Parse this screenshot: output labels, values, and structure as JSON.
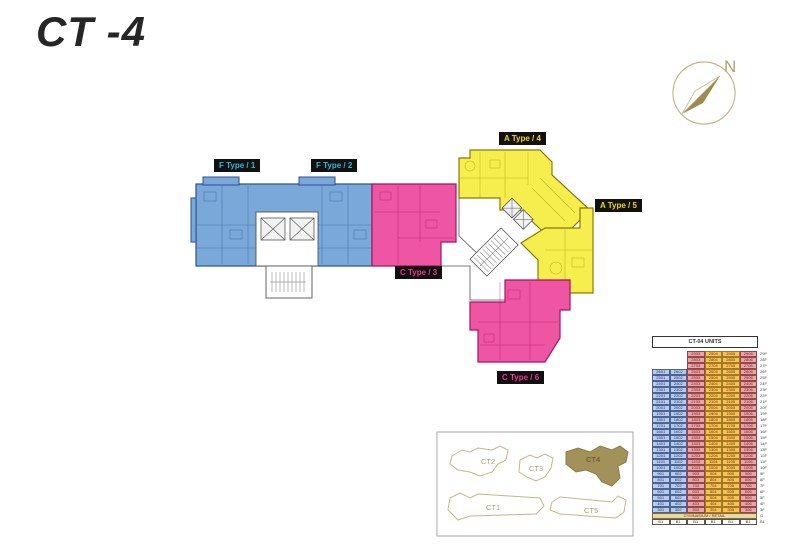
{
  "page": {
    "title": "CT -4",
    "background": "#ffffff"
  },
  "compass": {
    "label": "N",
    "ring_color": "#c7b687",
    "needle_color": "#9c8a52"
  },
  "plan": {
    "colors": {
      "f": "#7aa8d8",
      "f_line": "#2a4f8f",
      "c": "#ee55a3",
      "c_line": "#a81263",
      "a": "#f5ee4e",
      "a_line": "#8a7a00",
      "core": "#ffffff",
      "core_line": "#555555"
    },
    "labels": [
      {
        "text": "F Type / 1",
        "color": "#2fb6d9"
      },
      {
        "text": "F Type / 2",
        "color": "#2fb6d9"
      },
      {
        "text": "C Type / 3",
        "color": "#f0368c"
      },
      {
        "text": "A Type / 4",
        "color": "#f5d800"
      },
      {
        "text": "A Type / 5",
        "color": "#f5d800"
      },
      {
        "text": "C Type / 6",
        "color": "#f0368c"
      }
    ]
  },
  "key_plan": {
    "outline_color": "#c7b687",
    "highlight_fill": "#a29158",
    "buildings": [
      {
        "name": "CT2",
        "highlighted": false
      },
      {
        "name": "CT3",
        "highlighted": false
      },
      {
        "name": "CT4",
        "highlighted": true
      },
      {
        "name": "CT1",
        "highlighted": false
      },
      {
        "name": "CT5",
        "highlighted": false
      }
    ]
  },
  "table": {
    "title": "CT-04 UNITS",
    "columns": [
      {
        "bg": "#b9c9e8",
        "fg": "#1f3a6e",
        "border": "#4a6398"
      },
      {
        "bg": "#b9c9e8",
        "fg": "#1f3a6e",
        "border": "#4a6398"
      },
      {
        "bg": "#e2a6ab",
        "fg": "#7a1f1f",
        "border": "#9c4444"
      },
      {
        "bg": "#f4c54d",
        "fg": "#7a1f1f",
        "border": "#a3782a"
      },
      {
        "bg": "#f4c54d",
        "fg": "#7a1f1f",
        "border": "#a3782a"
      },
      {
        "bg": "#e2a6ab",
        "fg": "#7a1f1f",
        "border": "#9c4444"
      }
    ],
    "rows": [
      {
        "floor": "29F",
        "units": [
          "",
          "",
          "2903",
          "2904",
          "2905",
          "2906"
        ]
      },
      {
        "floor": "28F",
        "units": [
          "",
          "",
          "2803",
          "2804",
          "2805",
          "2806"
        ]
      },
      {
        "floor": "27F",
        "units": [
          "",
          "",
          "2703",
          "2704",
          "2705",
          "2706"
        ]
      },
      {
        "floor": "26F",
        "units": [
          "2601",
          "2602",
          "2603",
          "2604",
          "2605",
          "2606"
        ]
      },
      {
        "floor": "25F",
        "units": [
          "2501",
          "2502",
          "2503",
          "2504",
          "2505",
          "2506"
        ]
      },
      {
        "floor": "24F",
        "units": [
          "2401",
          "2402",
          "2403",
          "2404",
          "2405",
          "2406"
        ]
      },
      {
        "floor": "23F",
        "units": [
          "2301",
          "2302",
          "2303",
          "2304",
          "2305",
          "2306"
        ]
      },
      {
        "floor": "22F",
        "units": [
          "2201",
          "2202",
          "2203",
          "2204",
          "2205",
          "2206"
        ]
      },
      {
        "floor": "21F",
        "units": [
          "2101",
          "2102",
          "2103",
          "2104",
          "2105",
          "2106"
        ]
      },
      {
        "floor": "20F",
        "units": [
          "2001",
          "2002",
          "2003",
          "2004",
          "2005",
          "2006"
        ]
      },
      {
        "floor": "19F",
        "units": [
          "1901",
          "1902",
          "1903",
          "1904",
          "1905",
          "1906"
        ]
      },
      {
        "floor": "18F",
        "units": [
          "1801",
          "1802",
          "1803",
          "1804",
          "1805",
          "1806"
        ]
      },
      {
        "floor": "17F",
        "units": [
          "1701",
          "1702",
          "1703",
          "1704",
          "1705",
          "1706"
        ]
      },
      {
        "floor": "16F",
        "units": [
          "1601",
          "1602",
          "1603",
          "1604",
          "1605",
          "1606"
        ]
      },
      {
        "floor": "15F",
        "units": [
          "1501",
          "1502",
          "1503",
          "1504",
          "1505",
          "1506"
        ]
      },
      {
        "floor": "14F",
        "units": [
          "1401",
          "1402",
          "1403",
          "1404",
          "1405",
          "1406"
        ]
      },
      {
        "floor": "13F",
        "units": [
          "1301",
          "1302",
          "1303",
          "1304",
          "1305",
          "1306"
        ]
      },
      {
        "floor": "12F",
        "units": [
          "1201",
          "1202",
          "1203",
          "1204",
          "1205",
          "1206"
        ]
      },
      {
        "floor": "11F",
        "units": [
          "1101",
          "1102",
          "1103",
          "1104",
          "1105",
          "1106"
        ]
      },
      {
        "floor": "10F",
        "units": [
          "1001",
          "1002",
          "1003",
          "1004",
          "1005",
          "1006"
        ]
      },
      {
        "floor": "9F",
        "units": [
          "901",
          "902",
          "903",
          "904",
          "905",
          "906"
        ]
      },
      {
        "floor": "8F",
        "units": [
          "801",
          "802",
          "803",
          "804",
          "805",
          "806"
        ]
      },
      {
        "floor": "7F",
        "units": [
          "701",
          "702",
          "703",
          "704",
          "705",
          "706"
        ]
      },
      {
        "floor": "6F",
        "units": [
          "601",
          "602",
          "603",
          "604",
          "605",
          "606"
        ]
      },
      {
        "floor": "5F",
        "units": [
          "501",
          "502",
          "503",
          "504",
          "505",
          "506"
        ]
      },
      {
        "floor": "4F",
        "units": [
          "401",
          "402",
          "403",
          "404",
          "405",
          "406"
        ]
      },
      {
        "floor": "3F",
        "units": [
          "301",
          "302",
          "303",
          "304",
          "305",
          "306"
        ]
      }
    ],
    "amenity": {
      "label": "GYMNASIUM / RETAIL",
      "floor": "G",
      "bg": "#e8d9a8",
      "fg": "#7a1f1f"
    },
    "basement": {
      "cells": [
        "B1",
        "B1",
        "B1",
        "B1",
        "B1",
        "B1"
      ],
      "floor": "B1",
      "bg": "#ffffff",
      "fg": "#333333"
    }
  }
}
